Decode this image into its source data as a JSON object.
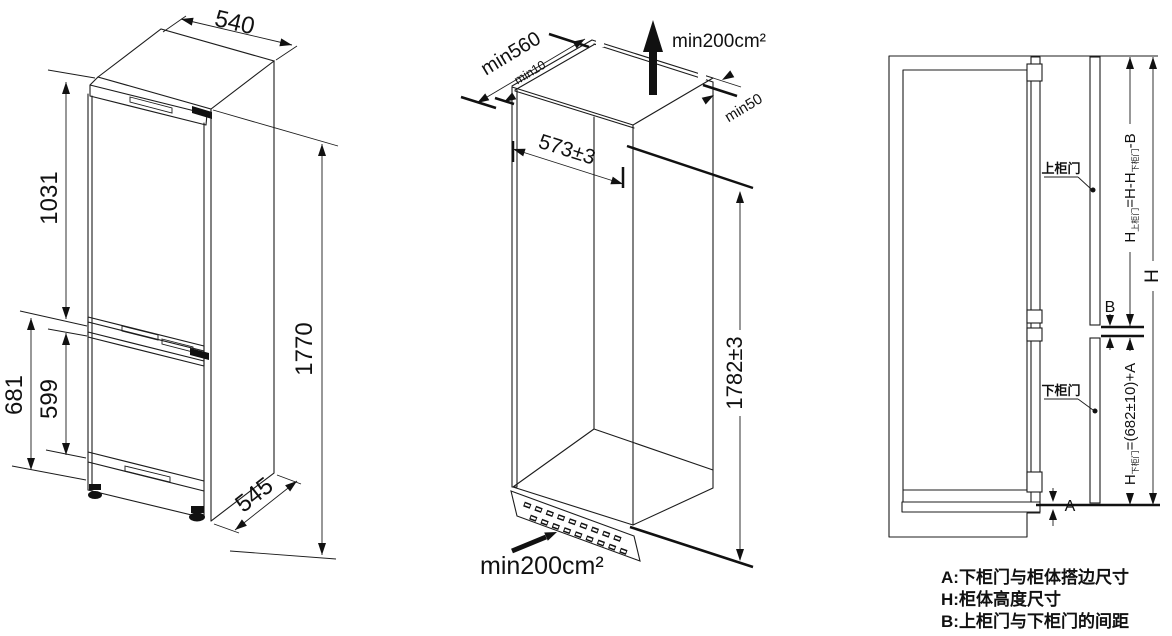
{
  "figure": {
    "left_view": {
      "top_width": "540",
      "upper_height": "1031",
      "outer_lower_height": "681",
      "lower_door_height": "599",
      "total_height": "1770",
      "depth": "545"
    },
    "middle_view": {
      "min_depth": "min560",
      "rear_gap": "min10",
      "side_gap": "min50",
      "top_vent": "min200cm²",
      "bottom_vent": "min200cm²",
      "niche_width": "573±3",
      "niche_height": "1782±3"
    },
    "right_view": {
      "upper_door": "上柜门",
      "lower_door": "下柜门",
      "h": "H",
      "b": "B",
      "a": "A",
      "upper_formula": {
        "p1": "H",
        "s1": "上柜门",
        "p2": "=H-H",
        "s2": "下柜门",
        "p3": "-B"
      },
      "lower_formula": {
        "p1": "H",
        "s1": "下柜门",
        "p2": "=(682±10)+A"
      }
    },
    "legend": {
      "line_a": "A:下柜门与柜体搭边尺寸",
      "line_h": "H:柜体高度尺寸",
      "line_b": "B:上柜门与下柜门的间距"
    }
  }
}
